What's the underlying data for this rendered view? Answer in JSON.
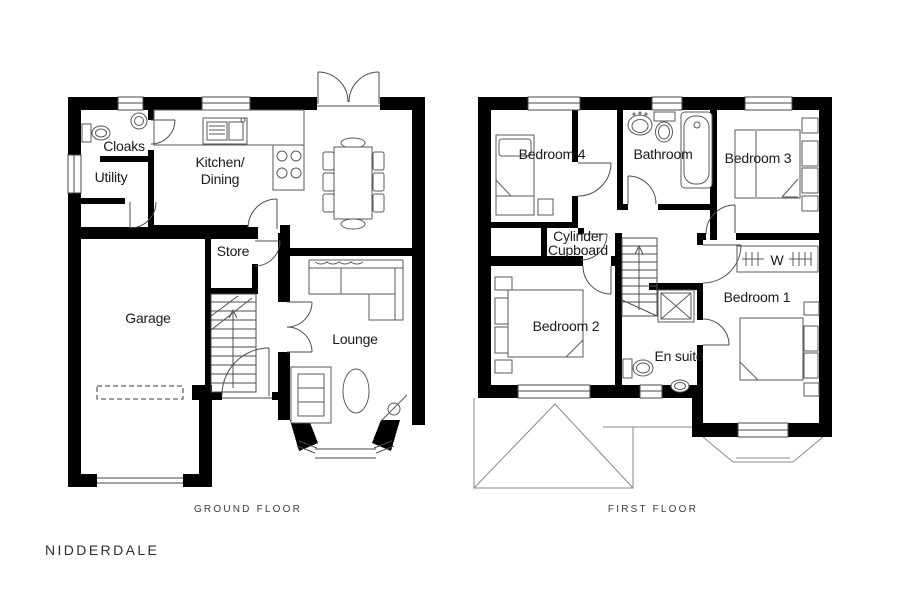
{
  "brand": "NIDDERDALE",
  "ground_floor": {
    "caption": "GROUND FLOOR",
    "rooms": {
      "cloaks": "Cloaks",
      "utility": "Utility",
      "kitchen_line1": "Kitchen/",
      "kitchen_line2": "Dining",
      "store": "Store",
      "garage": "Garage",
      "lounge": "Lounge"
    }
  },
  "first_floor": {
    "caption": "FIRST FLOOR",
    "rooms": {
      "bedroom4": "Bedroom 4",
      "bathroom": "Bathroom",
      "bedroom3": "Bedroom 3",
      "cylinder_line1": "Cylinder",
      "cylinder_line2": "Cupboard",
      "bedroom2": "Bedroom 2",
      "wardrobe": "W",
      "bedroom1": "Bedroom 1",
      "ensuite": "En suite"
    }
  },
  "colors": {
    "wall": "#000000",
    "detail": "#555555",
    "roof": "#888888",
    "label": "#1a1a1a",
    "caption": "#3a3a3a"
  }
}
